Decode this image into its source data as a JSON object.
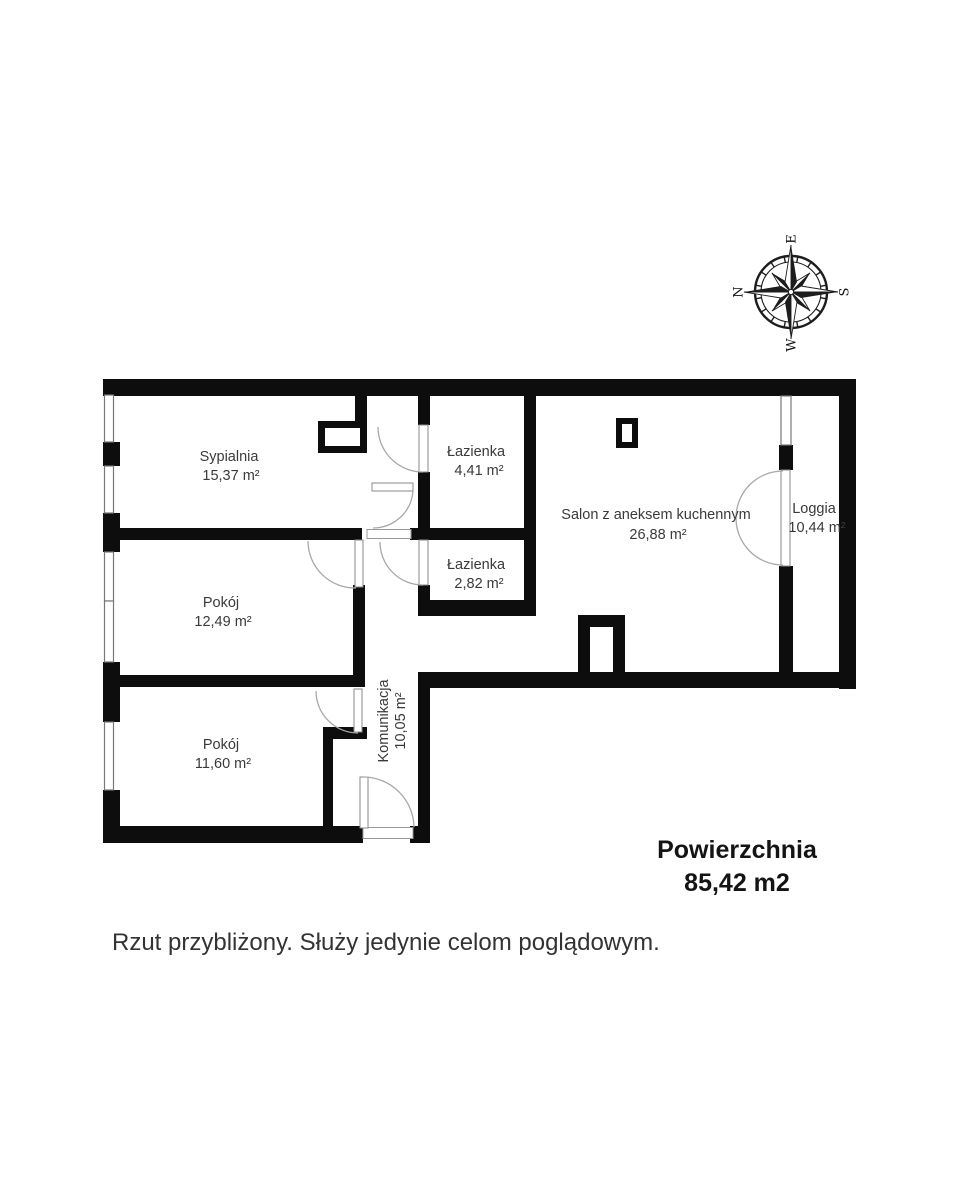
{
  "compass": {
    "n": "N",
    "e": "E",
    "s": "S",
    "w": "W"
  },
  "rooms": {
    "sypialnia": {
      "name": "Sypialnia",
      "area": "15,37 m²"
    },
    "lazienka_gorna": {
      "name": "Łazienka",
      "area": "4,41 m²"
    },
    "lazienka_dolna": {
      "name": "Łazienka",
      "area": "2,82 m²"
    },
    "salon": {
      "name": "Salon z aneksem kuchennym",
      "area": "26,88 m²"
    },
    "loggia": {
      "name": "Loggia",
      "area": "10,44 m²"
    },
    "pokoj_sredni": {
      "name": "Pokój",
      "area": "12,49 m²"
    },
    "pokoj_dolny": {
      "name": "Pokój",
      "area": "11,60 m²"
    },
    "komunikacja": {
      "name": "Komunikacja",
      "area": "10,05 m²"
    }
  },
  "summary": {
    "label": "Powierzchnia",
    "value": "85,42 m2"
  },
  "disclaimer": "Rzut przybliżony. Służy jedynie celom poglądowym.",
  "colors": {
    "wall": "#0d0d0d",
    "label_text": "#3a3a3a",
    "door_arc": "#a8a8a8",
    "window_line": "#777777"
  }
}
